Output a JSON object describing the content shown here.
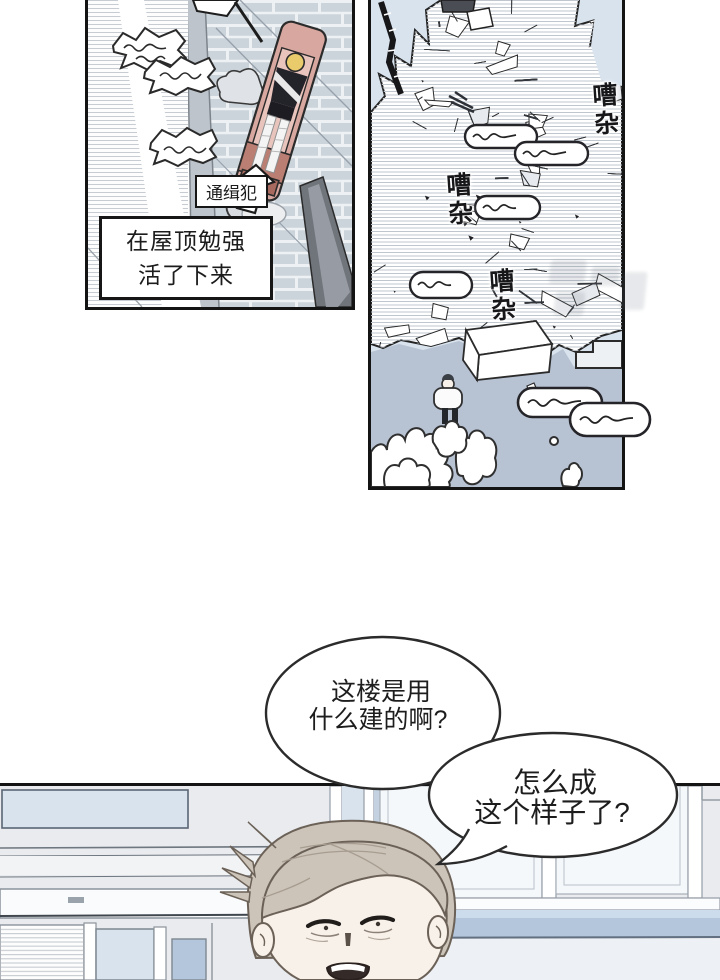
{
  "panel1": {
    "arrow_label": "通缉犯",
    "caption": {
      "line1": "在屋顶勉强",
      "line2": "活了下来"
    }
  },
  "panel2": {
    "sfx_noise": "嘈杂"
  },
  "speech": {
    "bubble1": {
      "line1": "这楼是用",
      "line2": "什么建的啊?"
    },
    "bubble2": {
      "line1": "怎么成",
      "line2": "这个样子了?"
    }
  },
  "colors": {
    "ink": "#1f1f1f",
    "sky": "#d9e3ee",
    "ground": "#b7c2d2",
    "brick": "#ccd4db",
    "wall_strip": "#bdc4cb",
    "stretcher": "#d8a79f",
    "stretcher_band": "#ba7e73",
    "beam": "#70757c",
    "victim_hair": "#eacb6c",
    "man_hair": "#cdc4b9",
    "skin": "#f8f1e9",
    "glass": "#d8e3ee",
    "sill": "#b3c6dc",
    "room_wall": "#e9ebef"
  }
}
